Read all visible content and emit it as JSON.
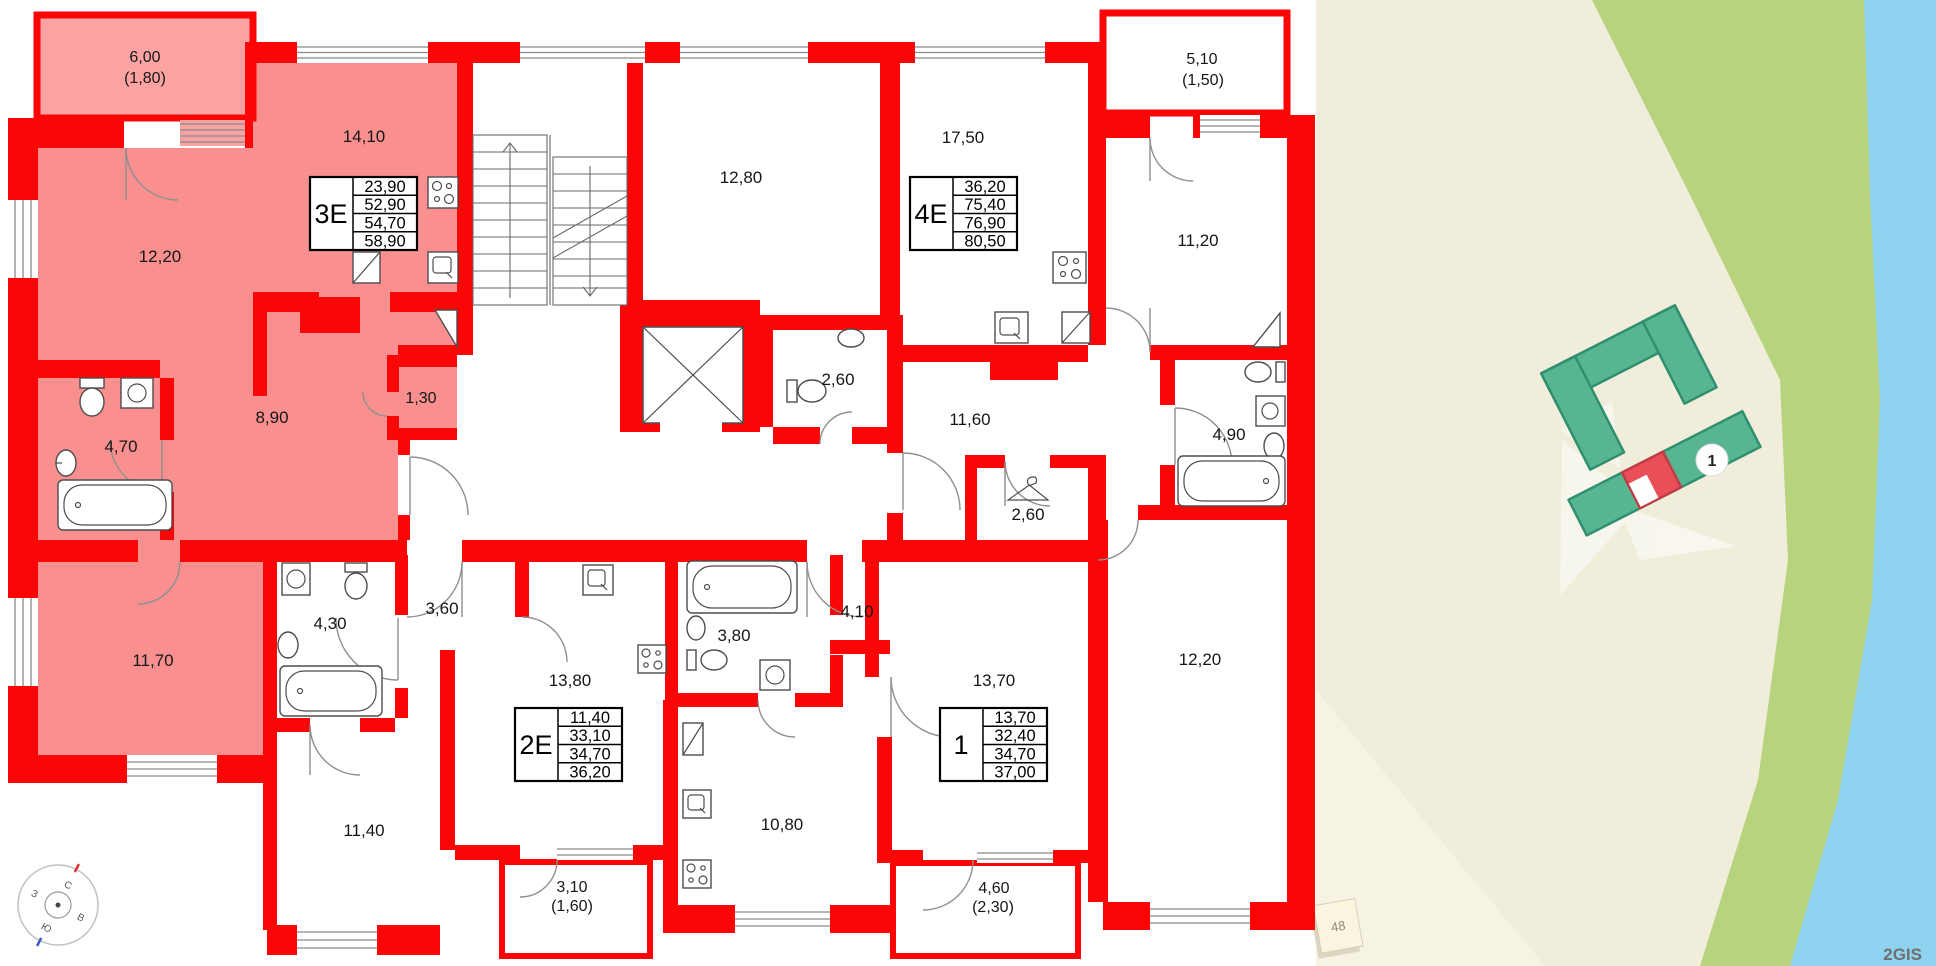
{
  "plan": {
    "room_labels": [
      {
        "text": "6,00"
      },
      {
        "text": "(1,80)"
      },
      {
        "text": "12,20"
      },
      {
        "text": "14,10"
      },
      {
        "text": "4,70"
      },
      {
        "text": "8,90"
      },
      {
        "text": "1,30"
      },
      {
        "text": "11,70"
      },
      {
        "text": "12,80"
      },
      {
        "text": "17,50"
      },
      {
        "text": "5,10"
      },
      {
        "text": "(1,50)"
      },
      {
        "text": "11,20"
      },
      {
        "text": "2,60"
      },
      {
        "text": "11,60"
      },
      {
        "text": "2,60"
      },
      {
        "text": "4,90"
      },
      {
        "text": "12,20"
      },
      {
        "text": "4,30"
      },
      {
        "text": "3,60"
      },
      {
        "text": "13,80"
      },
      {
        "text": "11,40"
      },
      {
        "text": "3,10"
      },
      {
        "text": "(1,60)"
      },
      {
        "text": "3,80"
      },
      {
        "text": "4,10"
      },
      {
        "text": "10,80"
      },
      {
        "text": "13,70"
      },
      {
        "text": "4,60"
      },
      {
        "text": "(2,30)"
      }
    ],
    "apartments": [
      {
        "type_label": "3Е",
        "areas": [
          "23,90",
          "52,90",
          "54,70",
          "58,90"
        ]
      },
      {
        "type_label": "4Е",
        "areas": [
          "36,20",
          "75,40",
          "76,90",
          "80,50"
        ]
      },
      {
        "type_label": "2Е",
        "areas": [
          "11,40",
          "33,10",
          "34,70",
          "36,20"
        ]
      },
      {
        "type_label": "1",
        "areas": [
          "13,70",
          "32,40",
          "34,70",
          "37,00"
        ]
      }
    ],
    "compass": {
      "north": "С",
      "east": "В",
      "south": "Ю",
      "west": "З"
    },
    "colors": {
      "wall": "#fb0606",
      "highlight": "#f9908f",
      "balcony_highlight": "#faa3a2"
    }
  },
  "map": {
    "building_badge": "1",
    "house_number": "48",
    "watermark": "2GIS",
    "colors": {
      "building": "#57b592",
      "building_outline": "#2f8f6f",
      "highlight_section": "#e84f56",
      "land": "#f0eddb",
      "green": "#b7d37e",
      "water": "#90d3f1"
    }
  }
}
